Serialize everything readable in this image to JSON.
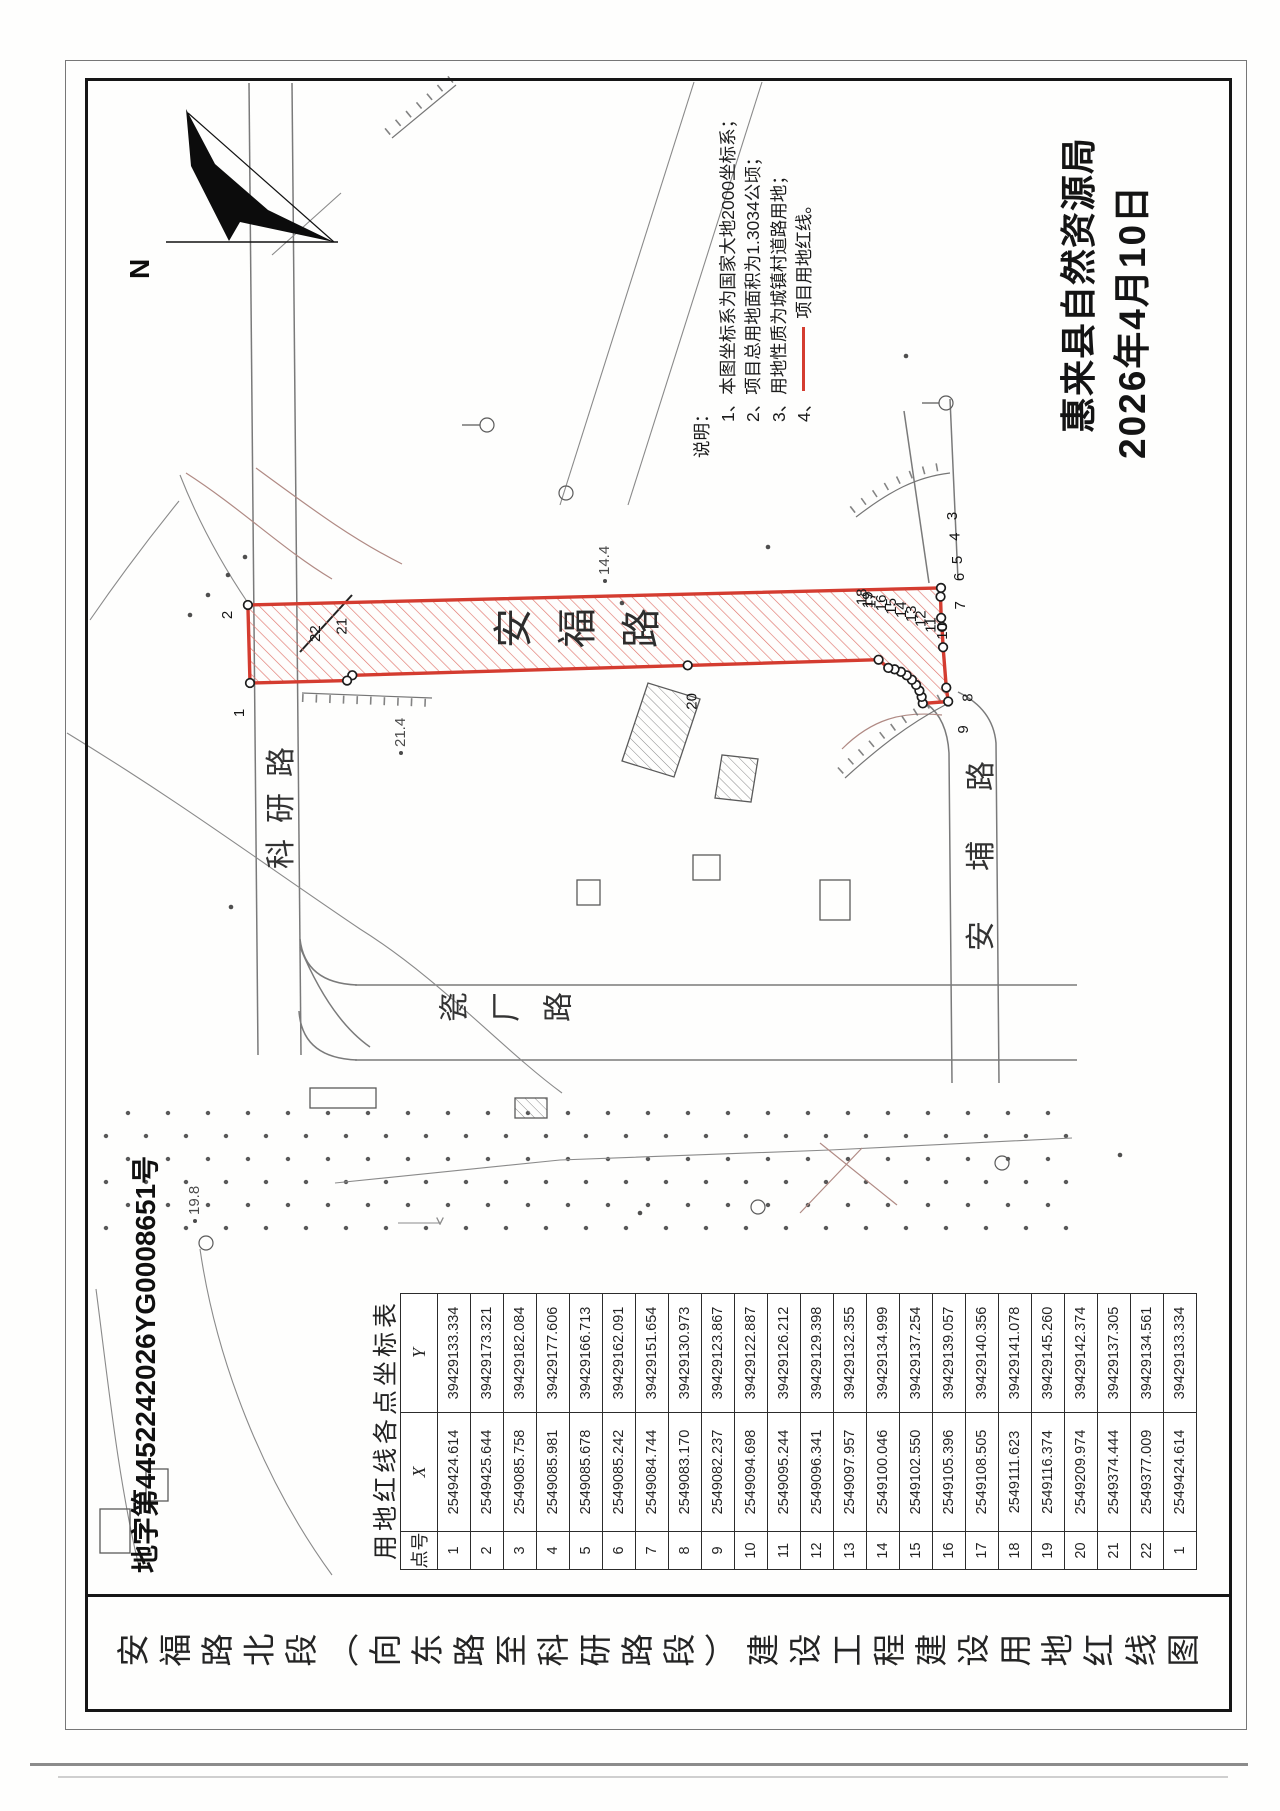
{
  "titles": {
    "drawing_title": "安福路北段（向东路至科研路段）建设工程建设用地红线图",
    "doc_number": "地字第4452242026YG0008651号"
  },
  "north_label": "N",
  "notes": {
    "heading": "说明：",
    "items": [
      "1、本图坐标系为国家大地2000坐标系；",
      "2、项目总用地面积为1.3034公顷；",
      "3、用地性质为城镇村道路用地；"
    ],
    "item4_prefix": "4、",
    "item4_text": "项目用地红线。"
  },
  "stamp": {
    "agency": "惠来县自然资源局",
    "date": "2026年4月10日"
  },
  "road_labels": {
    "anfu": "安福路",
    "keyan": "科研路",
    "cichang": "瓷厂路",
    "anbu": "安埔路"
  },
  "spot_elevations": {
    "a": "21.4",
    "b": "14.4",
    "c": "19.8"
  },
  "coordinate_table": {
    "title": "用地红线各点坐标表",
    "headers": [
      "点号",
      "X",
      "Y"
    ],
    "rows": [
      [
        "1",
        "2549424.614",
        "39429133.334"
      ],
      [
        "2",
        "2549425.644",
        "39429173.321"
      ],
      [
        "3",
        "2549085.758",
        "39429182.084"
      ],
      [
        "4",
        "2549085.981",
        "39429177.606"
      ],
      [
        "5",
        "2549085.678",
        "39429166.713"
      ],
      [
        "6",
        "2549085.242",
        "39429162.091"
      ],
      [
        "7",
        "2549084.744",
        "39429151.654"
      ],
      [
        "8",
        "2549083.170",
        "39429130.973"
      ],
      [
        "9",
        "2549082.237",
        "39429123.867"
      ],
      [
        "10",
        "2549094.698",
        "39429122.887"
      ],
      [
        "11",
        "2549095.244",
        "39429126.212"
      ],
      [
        "12",
        "2549096.341",
        "39429129.398"
      ],
      [
        "13",
        "2549097.957",
        "39429132.355"
      ],
      [
        "14",
        "2549100.046",
        "39429134.999"
      ],
      [
        "15",
        "2549102.550",
        "39429137.254"
      ],
      [
        "16",
        "2549105.396",
        "39429139.057"
      ],
      [
        "17",
        "2549108.505",
        "39429140.356"
      ],
      [
        "18",
        "2549111.623",
        "39429141.078"
      ],
      [
        "19",
        "2549116.374",
        "39429145.260"
      ],
      [
        "20",
        "2549209.974",
        "39429142.374"
      ],
      [
        "21",
        "2549374.444",
        "39429137.305"
      ],
      [
        "22",
        "2549377.009",
        "39429134.561"
      ],
      [
        "1",
        "2549424.614",
        "39429133.334"
      ]
    ]
  },
  "colors": {
    "redline": "#d43c30",
    "hatch": "#e0756c"
  }
}
